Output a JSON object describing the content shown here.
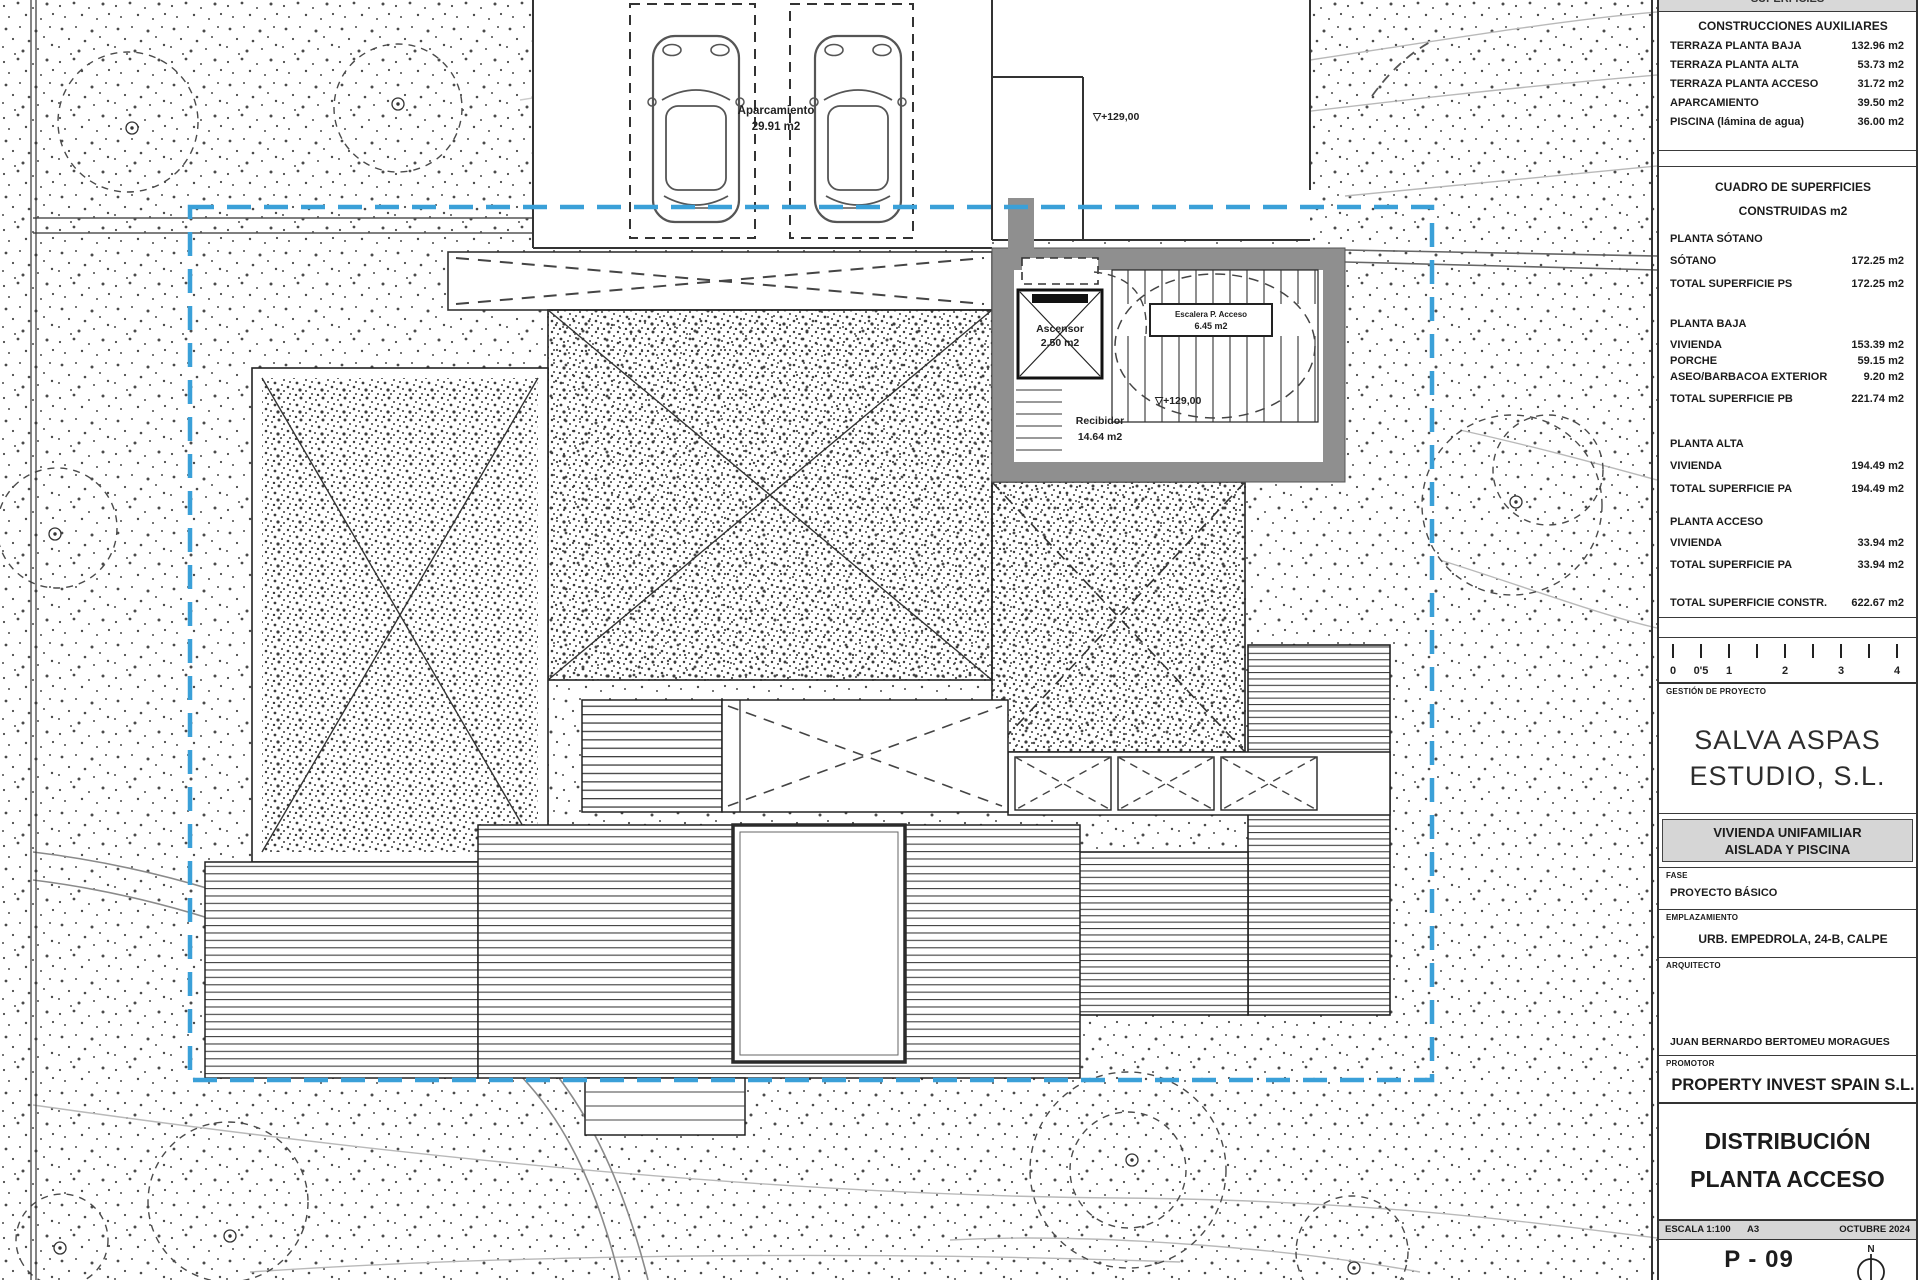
{
  "plan": {
    "labels": {
      "aparcamiento_1": "Aparcamiento",
      "aparcamiento_2": "29.91 m2",
      "level_court": "▽+129,00",
      "ascensor_1": "Ascensor",
      "ascensor_2": "2.50 m2",
      "escalera_1": "Escalera P. Acceso",
      "escalera_2": "6.45 m2",
      "level_hall": "▽+129,00",
      "recibidor_1": "Recibidor",
      "recibidor_2": "14.64 m2"
    },
    "colors": {
      "boundary_blue": "#3aa0d8",
      "wall_gray": "#8f8f8f",
      "bar_gray": "#d6d6d6"
    }
  },
  "titleblock": {
    "superficies_header": "SUPERFICIES",
    "aux": {
      "title": "CONSTRUCCIONES AUXILIARES",
      "rows": [
        {
          "label": "TERRAZA PLANTA BAJA",
          "value": "132.96 m2"
        },
        {
          "label": "TERRAZA PLANTA ALTA",
          "value": "53.73 m2"
        },
        {
          "label": "TERRAZA PLANTA ACCESO",
          "value": "31.72 m2"
        },
        {
          "label": "APARCAMIENTO",
          "value": "39.50 m2"
        },
        {
          "label": "PISCINA (lámina de agua)",
          "value": "36.00 m2"
        }
      ]
    },
    "cuadro": {
      "title1": "CUADRO DE SUPERFICIES",
      "title2": "CONSTRUIDAS m2",
      "groups": [
        {
          "heading": "PLANTA SÓTANO",
          "rows": [
            [
              "SÓTANO",
              "172.25 m2"
            ],
            [
              "TOTAL SUPERFICIE PS",
              "172.25 m2"
            ]
          ]
        },
        {
          "heading": "PLANTA BAJA",
          "rows": [
            [
              "VIVIENDA",
              "153.39 m2"
            ],
            [
              "PORCHE",
              "59.15 m2"
            ],
            [
              "ASEO/BARBACOA EXTERIOR",
              "9.20 m2"
            ],
            [
              "TOTAL SUPERFICIE PB",
              "221.74 m2"
            ]
          ]
        },
        {
          "heading": "PLANTA ALTA",
          "rows": [
            [
              "VIVIENDA",
              "194.49 m2"
            ],
            [
              "TOTAL SUPERFICIE PA",
              "194.49 m2"
            ]
          ]
        },
        {
          "heading": "PLANTA ACCESO",
          "rows": [
            [
              "VIVIENDA",
              "33.94 m2"
            ],
            [
              "TOTAL SUPERFICIE PA",
              "33.94 m2"
            ]
          ]
        }
      ],
      "total": {
        "label": "TOTAL SUPERFICIE CONSTR.",
        "value": "622.67 m2"
      }
    },
    "scalebar": {
      "labels": [
        "0",
        "0'5",
        "1",
        "2",
        "3",
        "4"
      ]
    },
    "gestion_label": "GESTIÓN DE PROYECTO",
    "studio": {
      "line1": "SALVA ASPAS",
      "line2": "ESTUDIO, S.L."
    },
    "project": {
      "line1": "VIVIENDA UNIFAMILIAR",
      "line2": "AISLADA Y PISCINA"
    },
    "fase": {
      "label": "FASE",
      "value": "PROYECTO BÁSICO"
    },
    "emplazamiento": {
      "label": "EMPLAZAMIENTO",
      "value": "URB. EMPEDROLA, 24-B, CALPE"
    },
    "arquitecto": {
      "label": "ARQUITECTO",
      "value": "JUAN BERNARDO BERTOMEU MORAGUES"
    },
    "promotor": {
      "label": "PROMOTOR",
      "value": "PROPERTY INVEST SPAIN S.L."
    },
    "drawing_title": {
      "line1": "DISTRIBUCIÓN",
      "line2": "PLANTA ACCESO"
    },
    "meta": {
      "escala": "ESCALA 1:100",
      "formato": "A3",
      "fecha": "OCTUBRE 2024"
    },
    "sheet_number": "P - 09",
    "north_label": "N"
  }
}
